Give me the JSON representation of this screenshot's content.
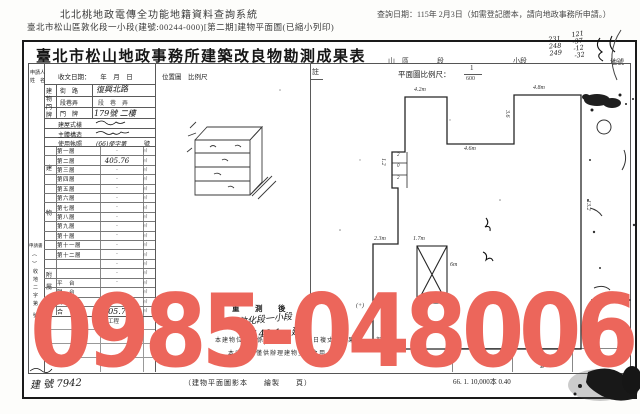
{
  "header": {
    "system_title": "北北桃地政電傳全功能地籍資料查詢系統",
    "query_date_note": "查詢日期：115年 2月3日（如需登記謄本，請向地政事務所申請。）",
    "document_line": "臺北市松山區敦化段一小段(建號:00244-000)[第二期]建物平面圖(已縮小列印)"
  },
  "doc": {
    "title": "臺北市松山地政事務所建築改良物勘測成果表",
    "head_labels": {
      "district": "山　區",
      "section": "段",
      "subsection": "小段",
      "lot": "地號"
    },
    "head_handwritten": {
      "col1": [
        "231",
        "248",
        "249"
      ],
      "col2": [
        "121",
        "-37",
        "-12",
        "-32"
      ]
    }
  },
  "form": {
    "applicant_line1": "申請人",
    "applicant_line2": "姓　名",
    "received_date": "收文日期：　　年　月　日",
    "location_scale": "位置圖　比例尺",
    "address_group": [
      "建",
      "物",
      "門",
      "牌"
    ],
    "street_label": "街　路",
    "street_value": "復興北路",
    "lane_label": "段巷弄",
    "lane_value": "段　巷　弄",
    "door_label": "門　牌",
    "door_value": "179號 二樓",
    "style_label": "建屋式樣",
    "structure_label": "主體構造",
    "permit_label": "使用執照",
    "permit_value": "(66)使字第",
    "permit_suffix": "號",
    "side_chars": [
      "建",
      "物",
      "附",
      "屬"
    ],
    "unit": "㎡",
    "floors": [
      {
        "label": "第一層",
        "value": "-"
      },
      {
        "label": "第二層",
        "value": "405.76"
      },
      {
        "label": "第三層",
        "value": "-"
      },
      {
        "label": "第四層",
        "value": "-"
      },
      {
        "label": "第五層",
        "value": "-"
      },
      {
        "label": "第六層",
        "value": "-"
      },
      {
        "label": "第七層",
        "value": "-"
      },
      {
        "label": "第八層",
        "value": "-"
      },
      {
        "label": "第九層",
        "value": "-"
      },
      {
        "label": "第十層",
        "value": "-"
      },
      {
        "label": "第十一層",
        "value": "-"
      },
      {
        "label": "第十二層",
        "value": "-"
      },
      {
        "label": "",
        "value": "-"
      },
      {
        "label": "",
        "value": "-"
      },
      {
        "label": "平　台",
        "value": "-"
      },
      {
        "label": "陽　台",
        "value": "-"
      },
      {
        "label": "騎　樓",
        "value": "-"
      },
      {
        "label": "合　計",
        "value": "405.76"
      }
    ],
    "eng_label": "工程",
    "application": {
      "title": "申請書",
      "paren": "（　）",
      "no_prefix": [
        "收",
        "地",
        "二",
        "字",
        "第"
      ],
      "no_suffix": "號"
    }
  },
  "plan": {
    "note": "註",
    "scale_label": "平面圖比例尺：",
    "scale_numerator": "1",
    "scale_denominator": "600",
    "dims": {
      "top_left": "4.2m",
      "top_right": "4.8m",
      "notch": "3.6",
      "step": "4.6m",
      "right": "13.2",
      "left_upper": "1.2",
      "left_a": "2.3m",
      "left_b": "1.7m",
      "shaft_w": "6m",
      "corner": "(+)",
      "cells": [
        "2",
        "0",
        "2"
      ]
    }
  },
  "resurvey": {
    "label": "重　測　後",
    "hand_line1": "敦化段一小段",
    "hand_line2": "140-1　建",
    "cert1": "本建物位置圖係依　　年　月　日複丈之成果　　　部分",
    "cert2": "本成果圖僅供辦理建物登記之用",
    "hand_no": "244"
  },
  "footer": {
    "building_no": "建 號 7942",
    "caption": "（建物平面圖影本　　繪製　　頁）",
    "code": "66. 1. 10,000本 0.40"
  },
  "watermark": {
    "text": "0985-048006",
    "color": "#ec665b"
  }
}
